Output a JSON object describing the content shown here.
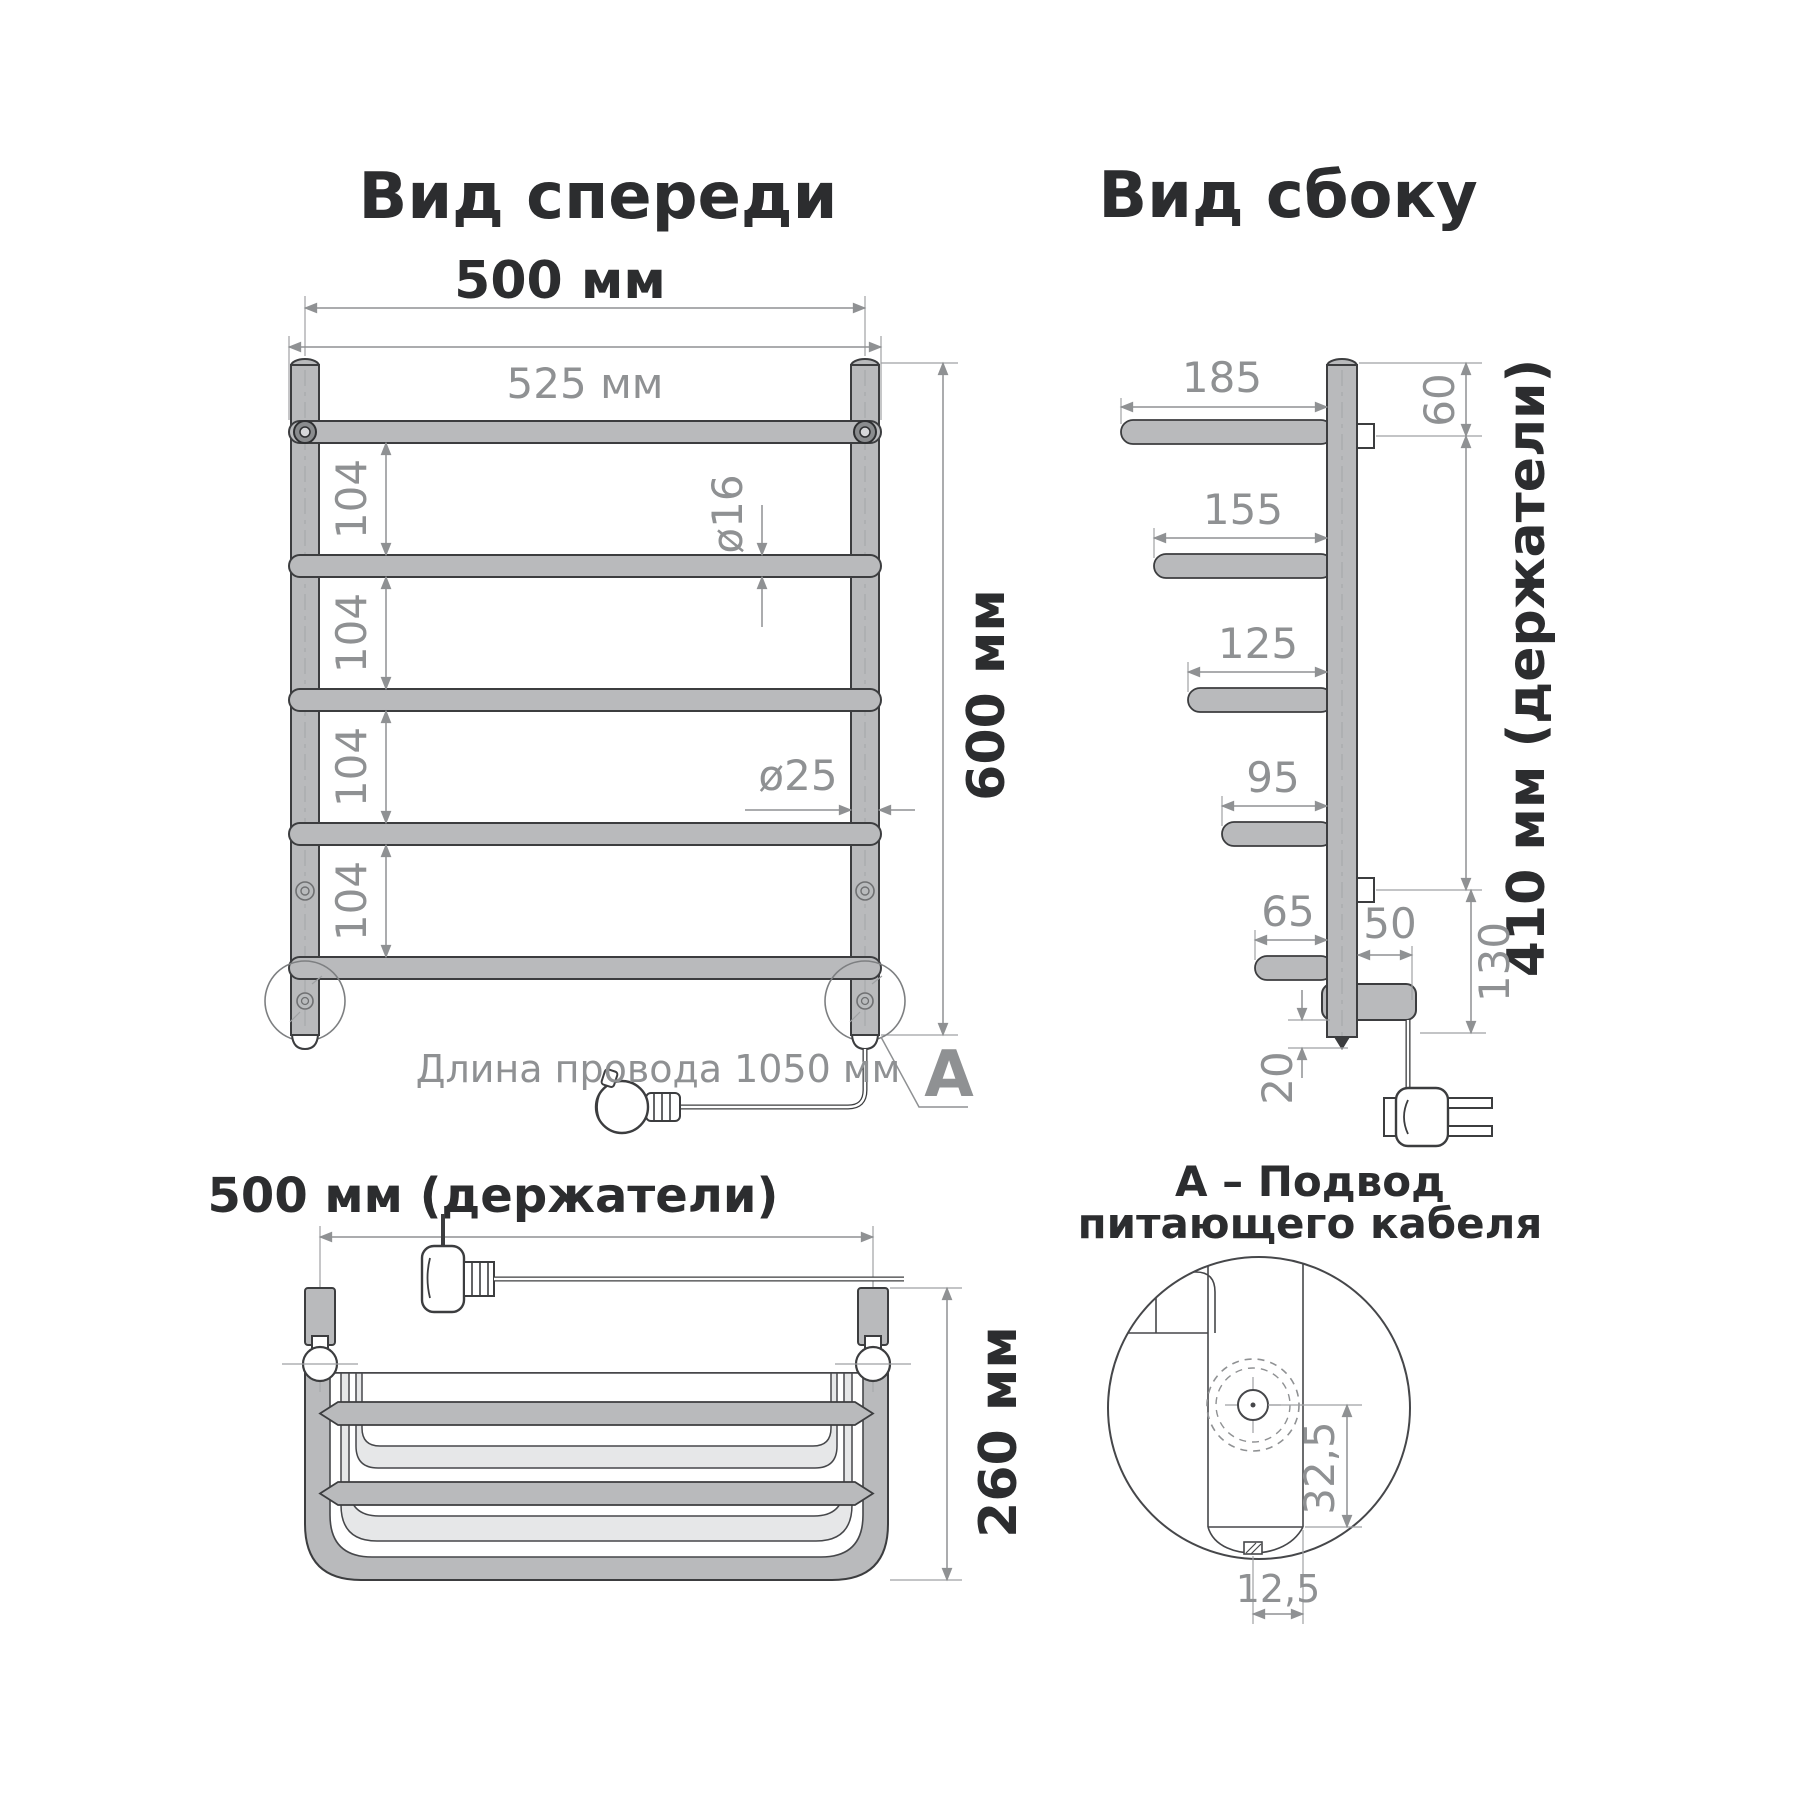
{
  "front_view": {
    "title": "Вид спереди",
    "dim_width_outer": "500 мм",
    "dim_width_rungs": "525 мм",
    "rung_spacings": [
      "104",
      "104",
      "104",
      "104"
    ],
    "dim_rung_diameter": "ø16",
    "dim_post_diameter": "ø25",
    "dim_height": "600 мм",
    "cable_label": "Длина провода 1050 мм",
    "detail_marker": "A"
  },
  "side_view": {
    "title": "Вид сбоку",
    "arm_lengths": [
      "185",
      "155",
      "125",
      "95",
      "65"
    ],
    "dim_top_offset": "60",
    "dim_bracket_span": "410 мм (держатели)",
    "dim_block_offset": "50",
    "dim_bottom": "130",
    "dim_tip": "20"
  },
  "top_view": {
    "title": "500 мм (держатели)",
    "dim_depth": "260 мм"
  },
  "detail_view": {
    "caption_line1": "А – Подвод",
    "caption_line2": "питающего кабеля",
    "dim_vertical": "32,5",
    "dim_horizontal": "12,5"
  },
  "colors": {
    "tube": "#b9babc",
    "tube_outline": "#3c3d3f",
    "dim_gray": "#8f9193",
    "dark_text": "#2c2d2f",
    "light_band": "#e6e7e8"
  }
}
